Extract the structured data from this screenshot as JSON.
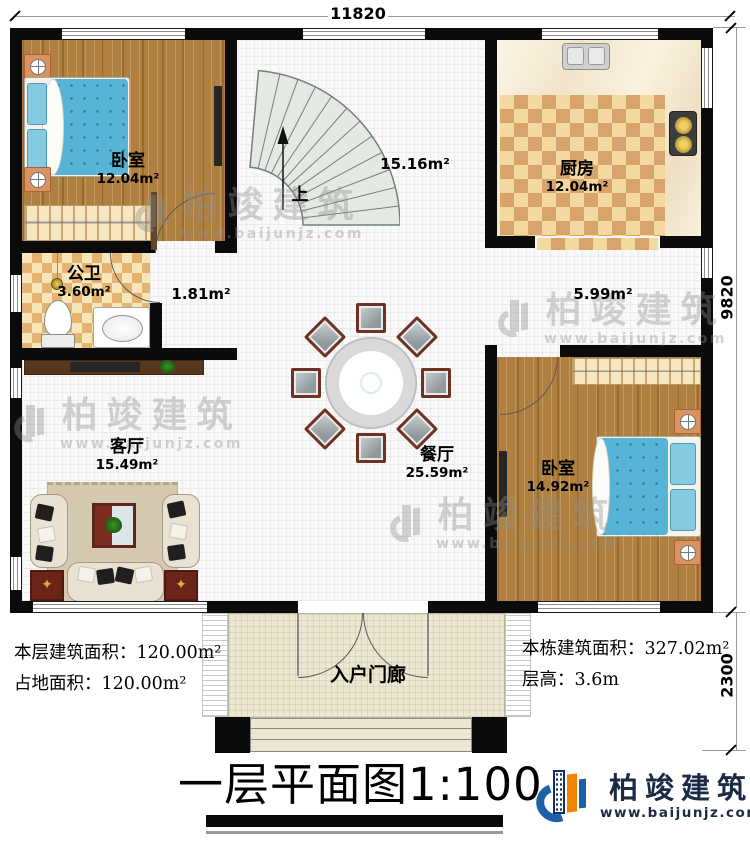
{
  "dimensions": {
    "top": "11820",
    "right_main": "9820",
    "right_porch": "2300"
  },
  "rooms": [
    {
      "name": "卧室",
      "area": "12.04m²"
    },
    {
      "name": "厨房",
      "area": "12.04m²"
    },
    {
      "name": "公卫",
      "area": "3.60m²"
    },
    {
      "name": "客厅",
      "area": "15.49m²"
    },
    {
      "name": "餐厅",
      "area": "25.59m²"
    },
    {
      "name": "卧室",
      "area": "14.92m²"
    },
    {
      "name": "入户门廊"
    }
  ],
  "areas": {
    "stair_hall": "15.16m²",
    "vestibule": "1.81m²",
    "corridor": "5.99m²"
  },
  "stairs": {
    "up_label": "上"
  },
  "notes": {
    "floor_area_label": "本层建筑面积：",
    "floor_area_value": "120.00m²",
    "land_area_label": "占地面积：",
    "land_area_value": "120.00m²",
    "total_area_label": "本栋建筑面积：",
    "total_area_value": "327.02m²",
    "height_label": "层高：",
    "height_value": "3.6m"
  },
  "title": {
    "main": "一层平面图",
    "scale": "1:100"
  },
  "brand": {
    "name": "柏竣建筑",
    "website": "www.baijunjz.com",
    "colors": {
      "blue": "#1d5fa8",
      "orange": "#f08300",
      "navy": "#1c2b45"
    }
  },
  "watermark": {
    "name": "柏竣建筑",
    "website": "www.baijunjz.com"
  }
}
